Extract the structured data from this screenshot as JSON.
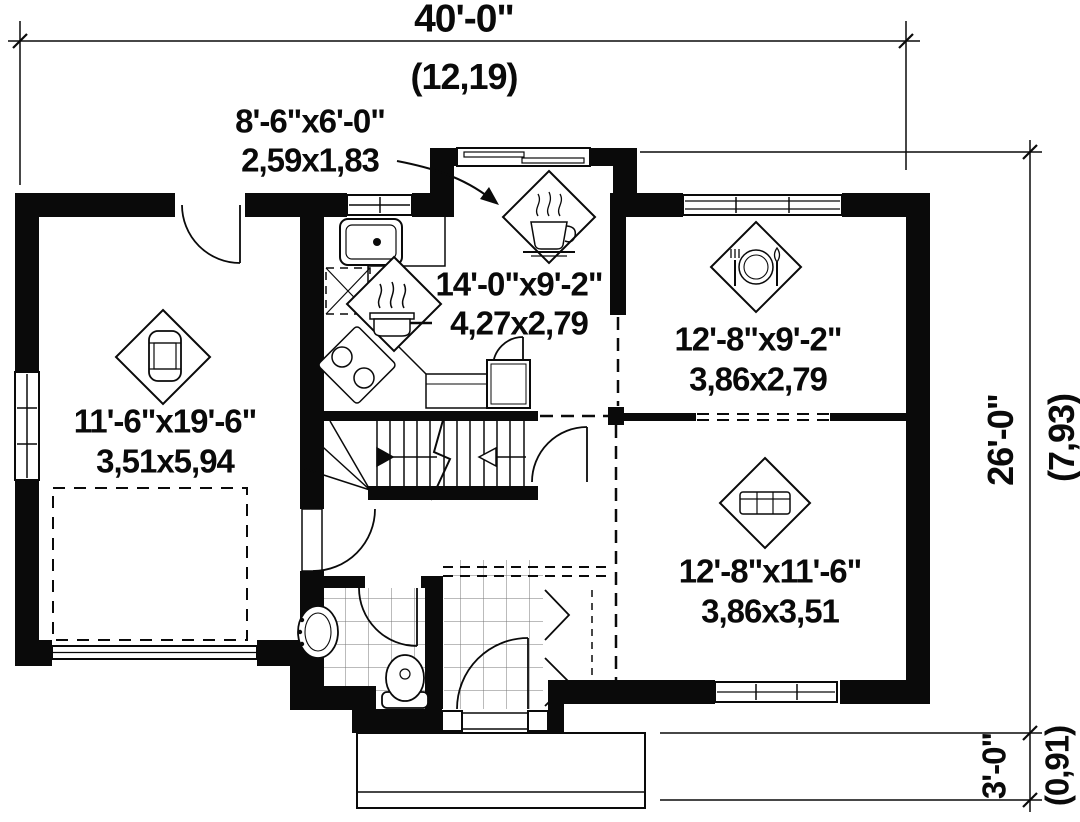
{
  "plan": {
    "dims": {
      "top_ft": "40'-0\"",
      "top_m": "(12,19)",
      "right_ft": "26'-0\"",
      "right_m": "(7,93)",
      "porch_ft": "3'-0\"",
      "porch_m": "(0,91)"
    },
    "rooms": {
      "nook": {
        "name": "breakfast-nook",
        "icon": "coffee-cup-icon",
        "ft": "8'-6\"x6'-0\"",
        "m": "2,59x1,83"
      },
      "kitchen": {
        "name": "kitchen",
        "icon": "cooking-pot-icon",
        "ft": "14'-0\"x9'-2\"",
        "m": "4,27x2,79"
      },
      "dining": {
        "name": "dining-room",
        "icon": "dining-plate-icon",
        "ft": "12'-8\"x9'-2\"",
        "m": "3,86x2,79"
      },
      "garage": {
        "name": "garage",
        "icon": "car-icon",
        "ft": "11'-6\"x19'-6\"",
        "m": "3,51x5,94"
      },
      "living": {
        "name": "living-room",
        "icon": "sofa-icon",
        "ft": "12'-8\"x11'-6\"",
        "m": "3,86x3,51"
      }
    },
    "colors": {
      "ink": "#0a0a0a",
      "paper": "#ffffff",
      "tile_line": "#777777"
    }
  }
}
